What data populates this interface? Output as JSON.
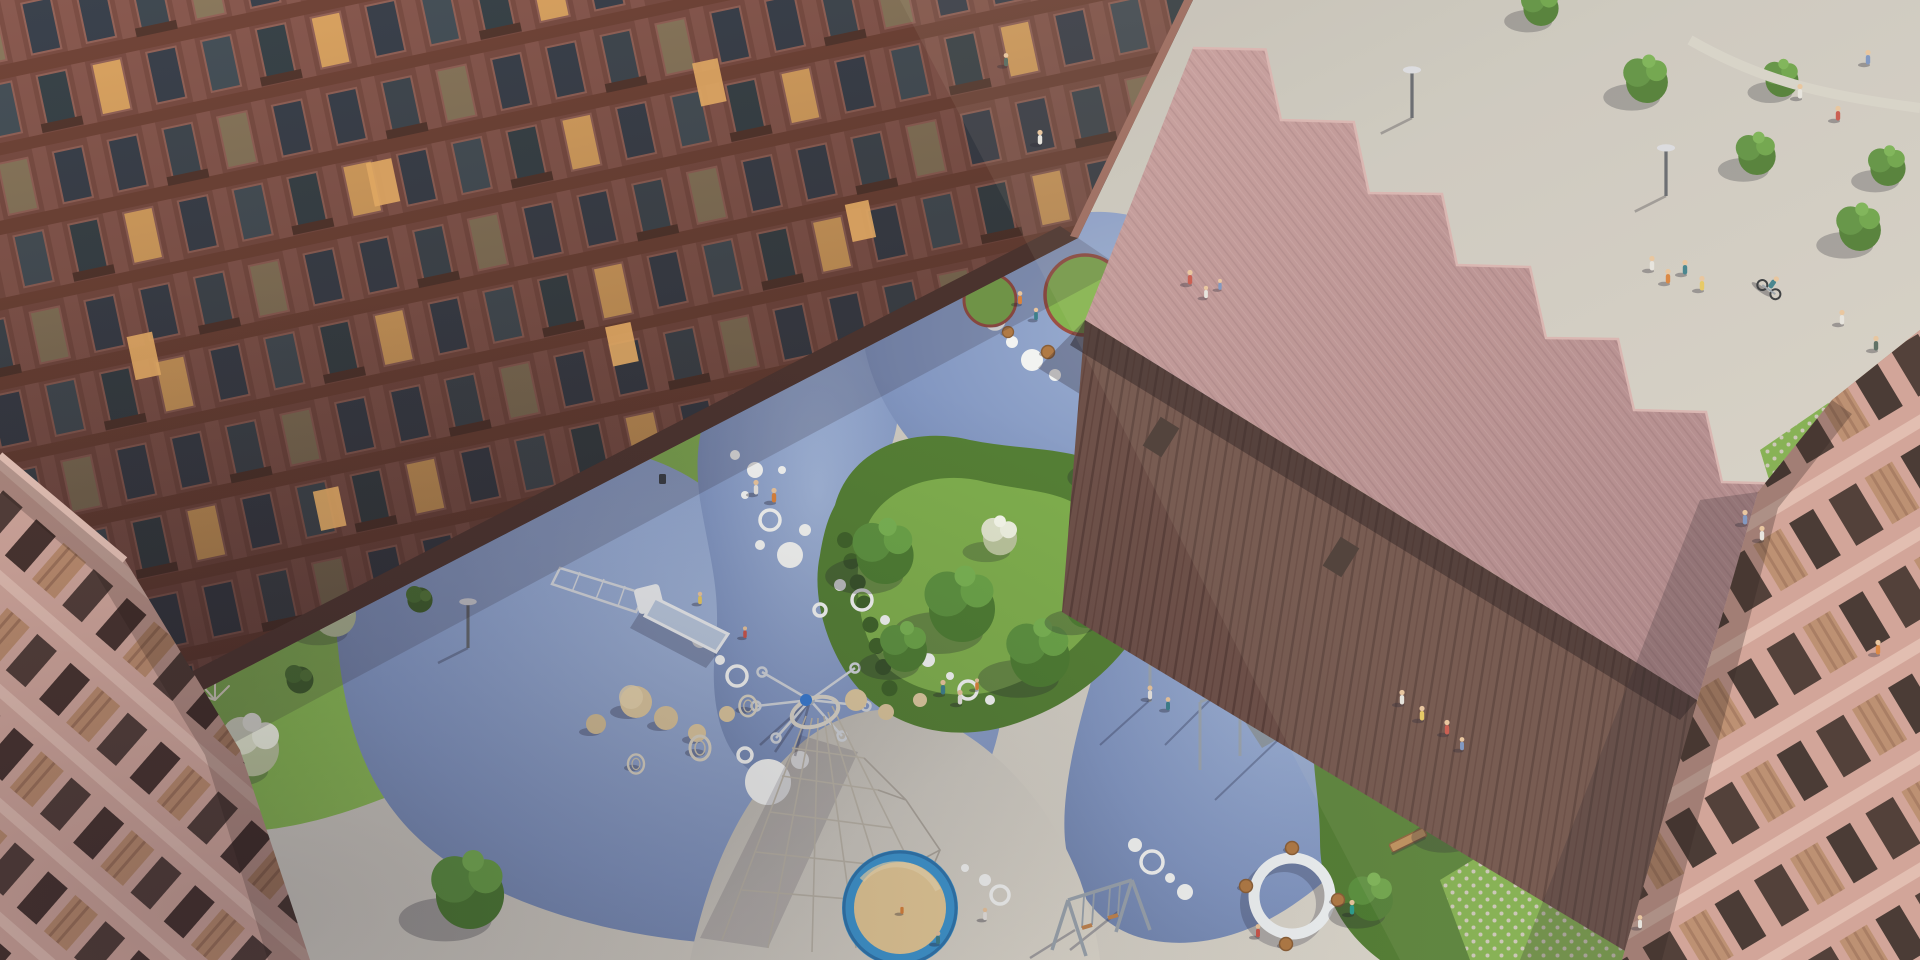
{
  "scene": {
    "type": "aerial-architectural-rendering",
    "description": "Bird's-eye dusk view of a residential courtyard: brick apartment block (top-left), pink sawtooth-roof pavilion (top-right), boulevard with road / bike lane / lawns beyond, organic blue rubber playground with white dot graphics, gardens, pink balconied buildings at left and right edges",
    "inventory": [
      "brick-apartment-building",
      "sawtooth-roof-pavilion",
      "left-pink-building",
      "right-pink-building",
      "street-with-cars",
      "zebra-crossing",
      "red-bike-lane",
      "cyclist",
      "blue-playground-surface",
      "slide",
      "rope-cone-climber",
      "carousel-spinner",
      "calisthenics-frames",
      "swing-set",
      "sandpit",
      "ring-bench",
      "basket-chairs",
      "stone-spheres",
      "picnic-lawn-circles",
      "canopy-table",
      "benches",
      "street-lamps",
      "trees",
      "white-flowering-shrubs",
      "pampas-grass",
      "grass-paver-lawns",
      "pedestrians"
    ]
  },
  "palette": {
    "paving": "#ccc8bf",
    "pavingLight": "#dcd7cb",
    "pavingShade": "#b4b0a8",
    "plaza": "#d3cfc6",
    "blue": "#8296c0",
    "blueLight": "#9fb2d4",
    "blueShade": "#6d80a8",
    "white": "#f2f3f1",
    "grass": "#79a84a",
    "grassLight": "#8fbe57",
    "grassDark": "#567f36",
    "bush": "#4c7531",
    "bushDark": "#40632a",
    "whiteBloom": "#e9ecd9",
    "pinkBloom": "#dab4c2",
    "pampas": "#e7e0cc",
    "sand": "#e5ca97",
    "sandRing": "#3f96cf",
    "road": "#90928c",
    "roadDark": "#83857f",
    "bikeLane": "#b05a4e",
    "brick": "#7d4f45",
    "brickPier": "#8a5a50",
    "brickSpandrel": "#734639",
    "windowGlass": "#3b424d",
    "windowLit": "#dfa763",
    "windowDim": "#8c7a5e",
    "windowFrame": "#96655a",
    "balconySlab": "#55382f",
    "roofPink": "#c69d9c",
    "roofPinkDark": "#ab8386",
    "slat": "#6e5149",
    "slatDark": "#5a403a",
    "pinkWallR": "#cfa095",
    "pinkSlabR": "#e0bbaf",
    "pinkWallL": "#d6ab9f",
    "pinkSlabL": "#e7c2b5",
    "winVoid": "#46342f",
    "balconyWood": "#b98a6c",
    "terracotta": "#a85a41",
    "wood": "#bc8d5a",
    "woodDark": "#8a5f38",
    "metal": "#9aa3ac",
    "metalDark": "#6f767e",
    "carDark": "#1d2126",
    "carDark2": "#14171c",
    "carGrey": "#30363d",
    "glass": "#46505c",
    "skin": "#e8c49c",
    "shadow": "rgba(38,32,46,0.30)",
    "shadowSoft": "rgba(42,36,52,0.18)"
  },
  "counts": {
    "cars": 5,
    "pedestrians": 30,
    "play_equipment": 7,
    "lawn_circles": 2
  }
}
